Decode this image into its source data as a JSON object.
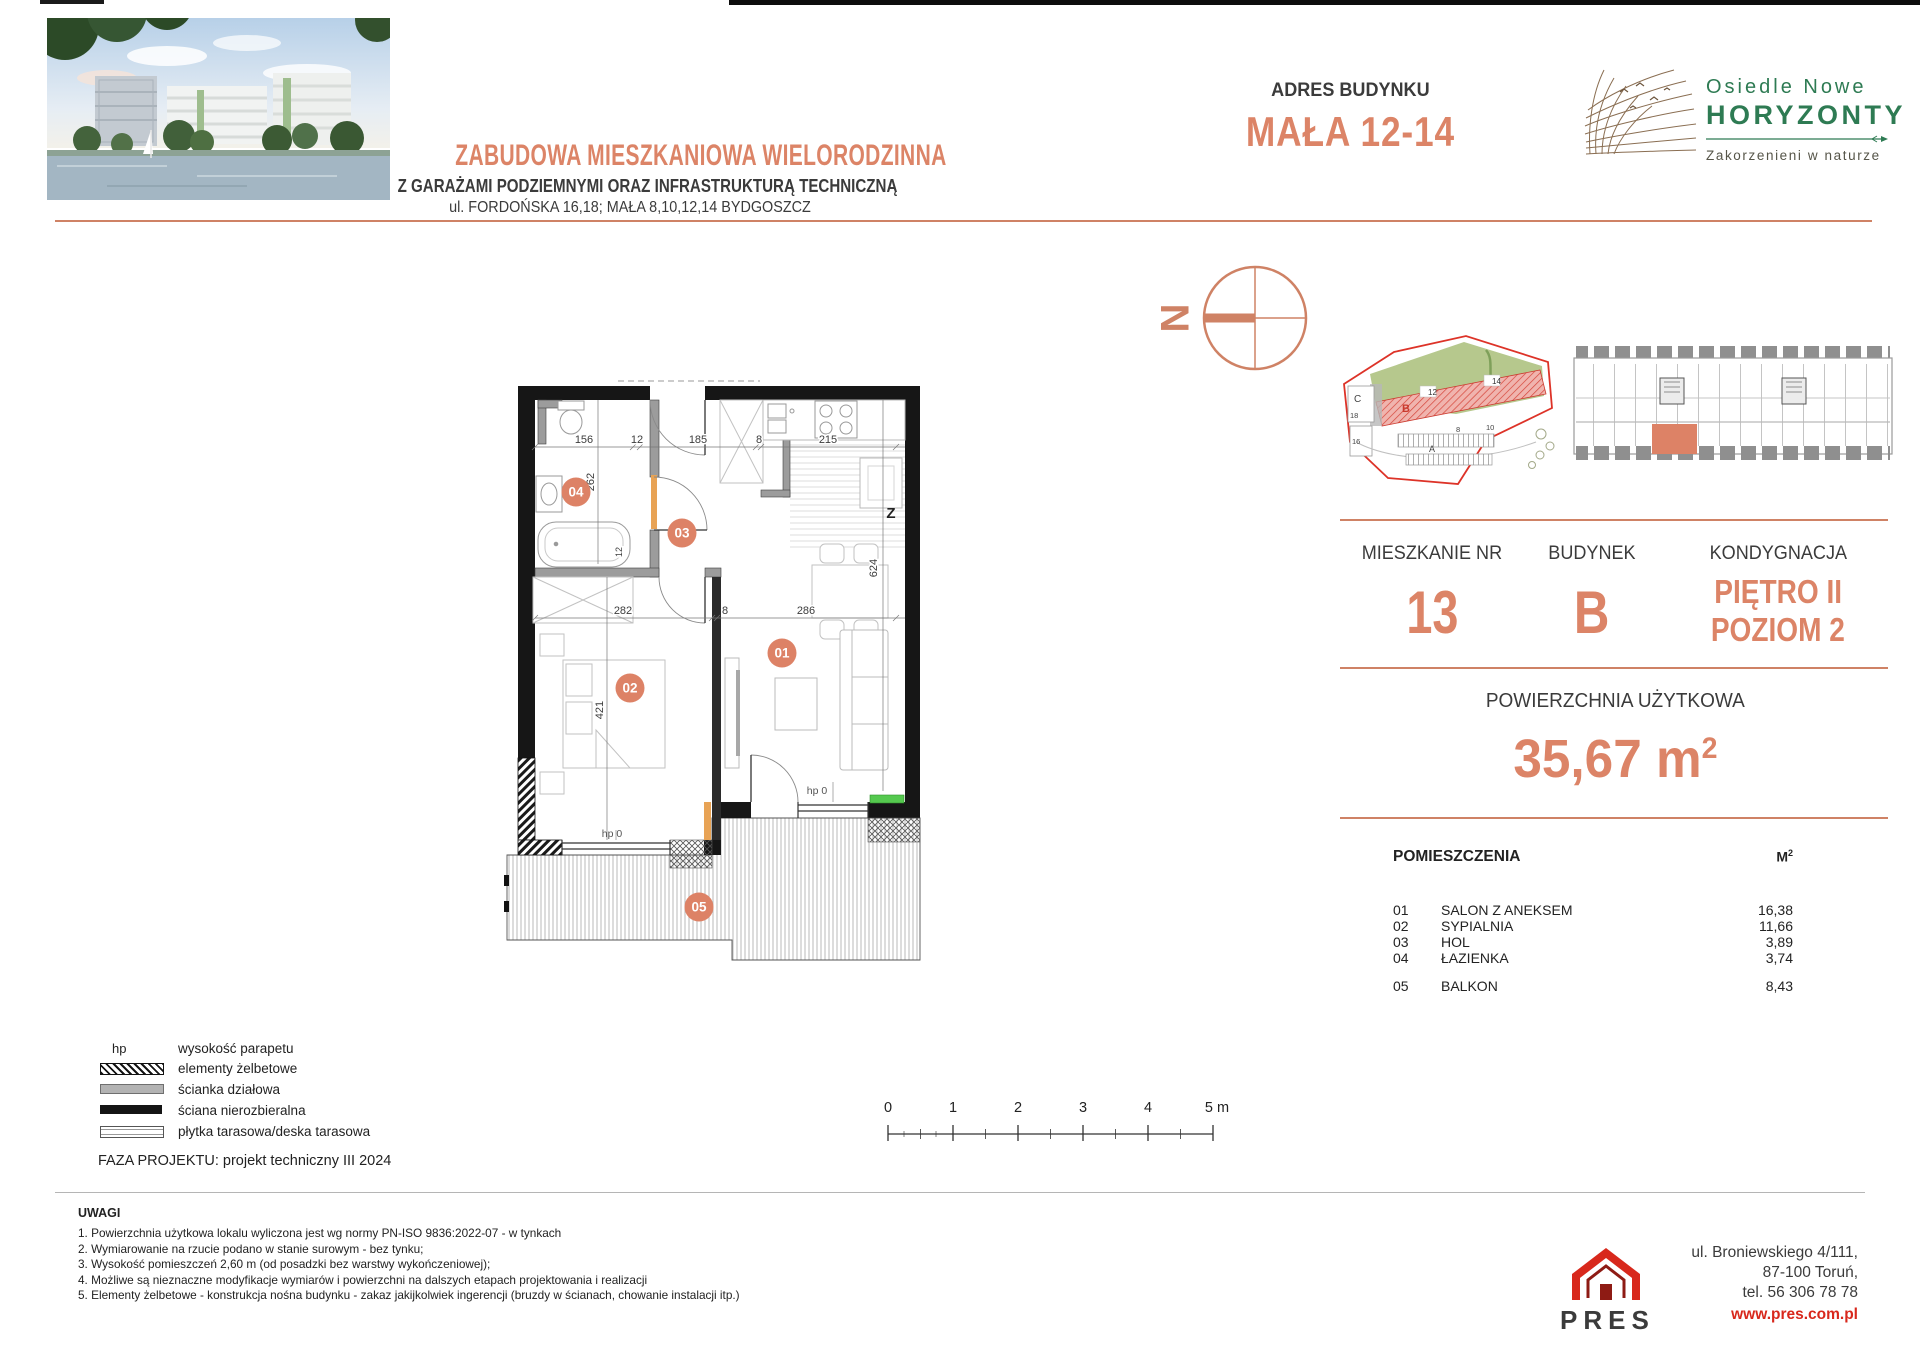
{
  "header": {
    "title": "ZABUDOWA MIESZKANIOWA WIELORODZINNA",
    "subtitle1": "Z GARAŻAMI PODZIEMNYMI ORAZ INFRASTRUKTURĄ TECHNICZNĄ",
    "subtitle2": "ul. FORDOŃSKA 16,18; MAŁA 8,10,12,14 BYDGOSZCZ",
    "address_label": "ADRES BUDYNKU",
    "address_value": "MAŁA 12-14",
    "logo_line1": "Osiedle Nowe",
    "logo_line2": "HORYZONTY",
    "logo_tagline": "Zakorzenieni w naturze"
  },
  "info": {
    "apartment_label": "MIESZKANIE NR",
    "apartment_value": "13",
    "building_label": "BUDYNEK",
    "building_value": "B",
    "floor_label": "KON​DYGNACJA",
    "floor_line1": "PIĘTRO II",
    "floor_line2": "POZIOM 2",
    "area_label": "POWIERZCHNIA UŻYTKOWA",
    "area_value": "35,67 m",
    "area_sup": "2"
  },
  "rooms": {
    "header_name": "POMIESZCZENIA",
    "header_unit": "M",
    "header_unit_sup": "2",
    "items": [
      {
        "no": "01",
        "name": "SALON Z ANEKSEM",
        "area": "16,38"
      },
      {
        "no": "02",
        "name": "SYPIALNIA",
        "area": "11,66"
      },
      {
        "no": "03",
        "name": "HOL",
        "area": "3,89"
      },
      {
        "no": "04",
        "name": "ŁAZIENKA",
        "area": "3,74"
      },
      {
        "no": "05",
        "name": "BALKON",
        "area": "8,43"
      }
    ]
  },
  "plan": {
    "badges": [
      "01",
      "02",
      "03",
      "04",
      "05"
    ],
    "dim_top": [
      "156",
      "12",
      "185",
      "8",
      "215"
    ],
    "dim_mid": [
      "282",
      "8",
      "286"
    ],
    "dim_262": "262",
    "dim_12": "12",
    "dim_421": "421",
    "dim_624": "624",
    "hp1": "hp 0",
    "hp2": "hp 0",
    "kitchen_mark": "Z",
    "north": "N"
  },
  "site_map": {
    "b": "B",
    "c": "C",
    "a": "A",
    "n12": "12",
    "n14": "14",
    "n18": "18",
    "n16": "16",
    "n8": "8",
    "n10": "10"
  },
  "scalebar": {
    "labels": [
      "0",
      "1",
      "2",
      "3",
      "4",
      "5 m"
    ]
  },
  "legend": {
    "items": [
      {
        "sym": "hp",
        "label": "wysokość parapetu"
      },
      {
        "label": "elementy żelbetowe"
      },
      {
        "label": "ścianka działowa"
      },
      {
        "label": "ściana nierozbieralna"
      },
      {
        "label": "płytka tarasowa/deska tarasowa"
      }
    ]
  },
  "phase": "FAZA PROJEKTU: projekt techniczny III 2024",
  "notes": {
    "title": "UWAGI",
    "items": [
      "1. Powierzchnia użytkowa lokalu wyliczona jest wg normy PN-ISO 9836:2022-07 - w tynkach",
      "2. Wymiarowanie na rzucie podano w stanie surowym - bez tynku;",
      "3. Wysokość pomieszczeń 2,60 m (od posadzki bez warstwy wykończeniowej);",
      "4. Możliwe są nieznaczne modyfikacje wymiarów i powierzchni na dalszych etapach projektowania i realizacji",
      "5. Elementy żelbetowe - konstrukcja nośna budynku - zakaz jakijkolwiek ingerencji (bruzdy w ścianach, chowanie instalacji itp.)"
    ]
  },
  "footer": {
    "brand": "PRES",
    "address1": "ul. Broniewskiego  4/111,",
    "address2": "87-100 Toruń,",
    "address3": "tel. 56 306 78 78",
    "website": "www.pres.com.pl"
  }
}
